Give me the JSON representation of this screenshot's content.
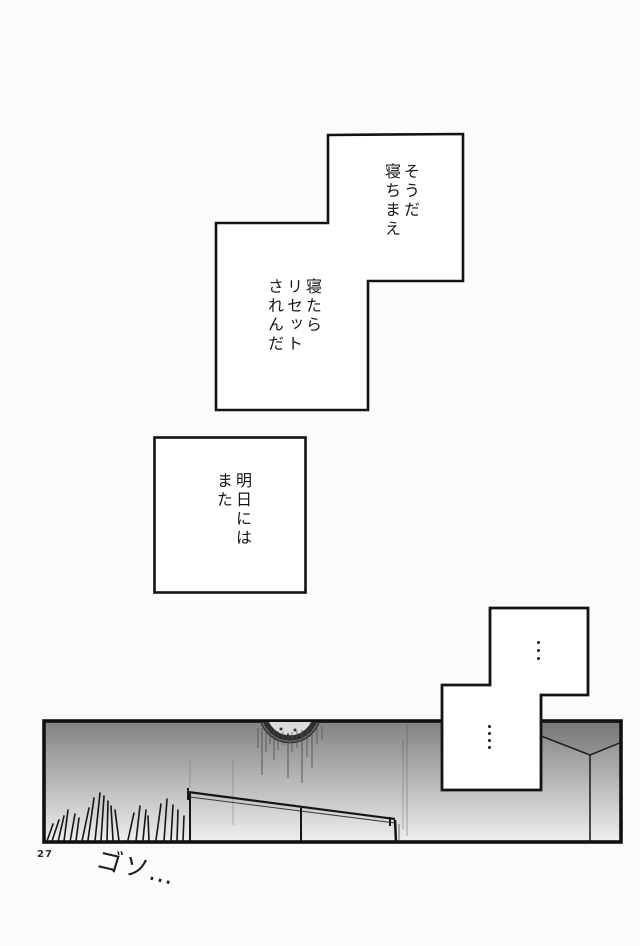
{
  "page": {
    "background_color": "#fbfbfb",
    "ink_color": "#161616",
    "number": "27",
    "sfx": "ゴソ…"
  },
  "dialogues": [
    {
      "panel": "top-stepped-upper",
      "columns": [
        "そうだ",
        "寝ちまえ"
      ]
    },
    {
      "panel": "top-stepped-lower",
      "columns": [
        "寝たら",
        "リセット",
        "されんだ"
      ]
    },
    {
      "panel": "middle-square",
      "columns": [
        "明日には",
        "また"
      ]
    },
    {
      "panel": "bottom-stepped-upper",
      "dots": 3
    },
    {
      "panel": "bottom-stepped-lower",
      "dots": 4
    }
  ],
  "artwork": {
    "gradient_top": "#828282",
    "gradient_mid": "#b2b2b2",
    "gradient_bottom": "#efefef",
    "line_color": "#1a1a1a",
    "elements": [
      "wall-clock",
      "ink-drips",
      "bed-rail",
      "grass-hatching",
      "room-corner"
    ]
  }
}
